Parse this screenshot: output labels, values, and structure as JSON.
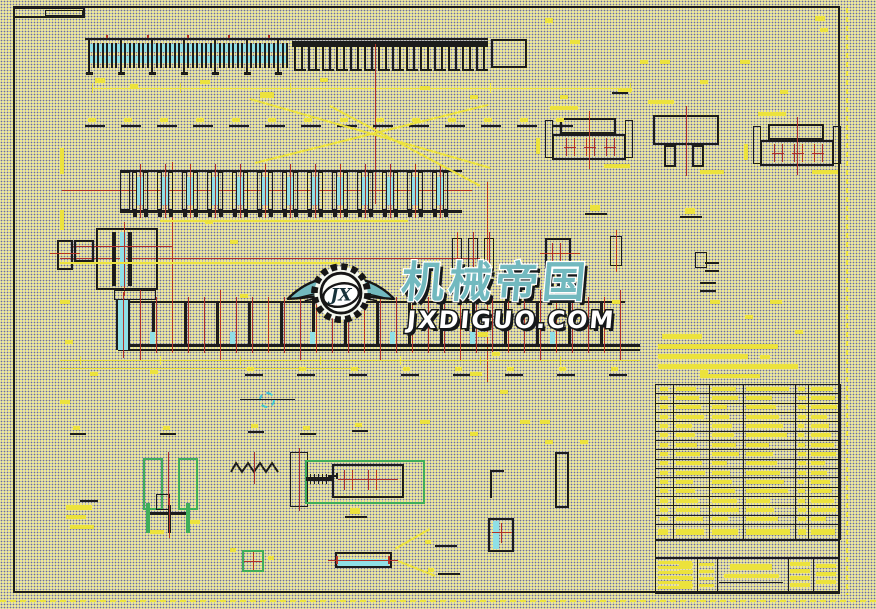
{
  "watermark": {
    "brand": "机械帝国",
    "domain": "JXDIGUO.COM",
    "monogram": "JX"
  },
  "palette": {
    "ink": "#1c1c1c",
    "red": "#b03028",
    "cyan": "#8fdfe6",
    "cyan2": "#3fc6d2",
    "yellow": "#ece23c",
    "green": "#3fae5a",
    "teal": "#72b9bf",
    "shadow": "#15181a"
  }
}
